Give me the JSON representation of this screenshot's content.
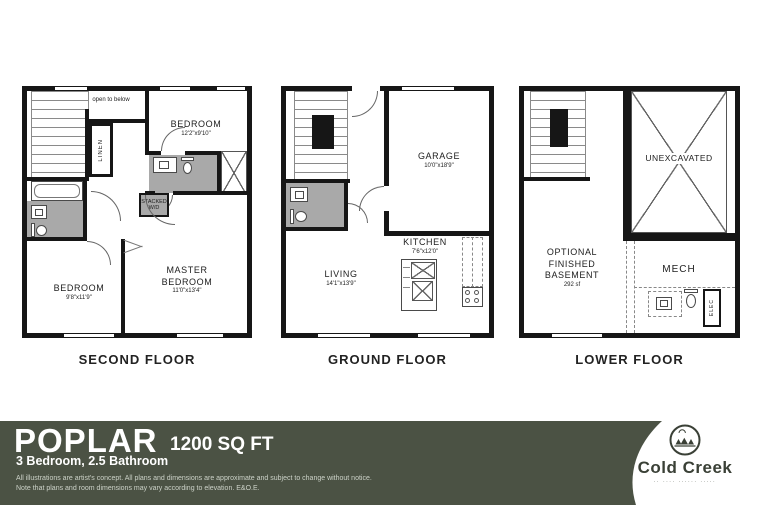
{
  "colors": {
    "banner_bg": "#4b5244",
    "wall": "#161616",
    "fixture_gray": "#a9a9a9",
    "logo_ink": "#3a4036"
  },
  "floors": {
    "second": {
      "label": "SECOND FLOOR",
      "rooms": {
        "bedroom_right": {
          "name": "BEDROOM",
          "dims": "12'2\"x9'10\""
        },
        "bedroom_left": {
          "name": "BEDROOM",
          "dims": "9'8\"x11'9\""
        },
        "master": {
          "line1": "MASTER",
          "line2": "BEDROOM",
          "dims": "11'0\"x13'4\""
        }
      },
      "annotations": {
        "open_to_below": "open to below",
        "linen": "LINEN",
        "washer_dryer": "STACKED\nW/D"
      }
    },
    "ground": {
      "label": "GROUND FLOOR",
      "rooms": {
        "garage": {
          "name": "GARAGE",
          "dims": "10'0\"x18'9\""
        },
        "kitchen": {
          "name": "KITCHEN",
          "dims": "7'6\"x12'0\""
        },
        "living": {
          "name": "LIVING",
          "dims": "14'1\"x13'9\""
        }
      }
    },
    "lower": {
      "label": "LOWER FLOOR",
      "rooms": {
        "unexcavated": {
          "name": "UNEXCAVATED"
        },
        "basement": {
          "line1": "OPTIONAL",
          "line2": "FINISHED",
          "line3": "BASEMENT",
          "area": "292 sf"
        },
        "mech": {
          "name": "MECH"
        }
      },
      "annotations": {
        "elec": "ELEC"
      }
    }
  },
  "banner": {
    "model": "POPLAR",
    "sqft": "1200 SQ FT",
    "specs": "3 Bedroom, 2.5 Bathroom",
    "disclaimer1": "All illustrations are artist's concept. All plans and dimensions are approximate and subject to change without notice.",
    "disclaimer2": "Note that plans and room dimensions may vary according to elevation. E&O.E."
  },
  "logo": {
    "brand": "Cold Creek",
    "tagline": "·· ···· ······ ·····"
  }
}
